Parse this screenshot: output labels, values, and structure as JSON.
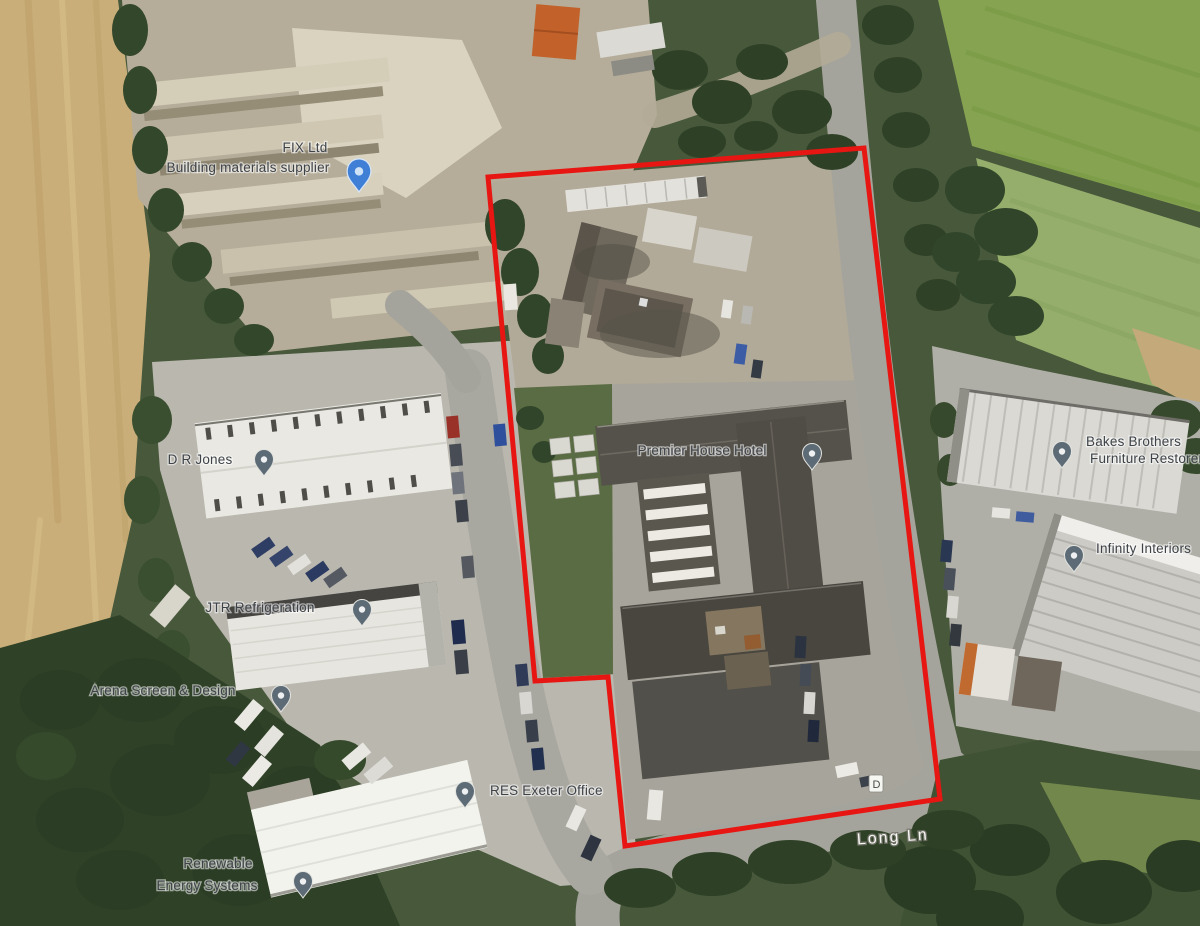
{
  "map": {
    "view": "satellite",
    "road_label": "Long Ln",
    "parcel_marker": "D",
    "boundary_color": "#e81613",
    "pin_color_gray": "#5c6b75",
    "pin_color_blue": "#3f7fd6",
    "pois": {
      "fix": {
        "name": "FIX Ltd",
        "subtitle": "Building materials supplier"
      },
      "dr_jones": {
        "name": "D R Jones"
      },
      "jtr": {
        "name": "JTR Refrigeration"
      },
      "arena": {
        "name": "Arena Screen & Design"
      },
      "premier": {
        "name": "Premier House Hotel"
      },
      "res": {
        "name": "RES Exeter Office"
      },
      "renewable": {
        "line1": "Renewable",
        "line2": "Energy Systems"
      },
      "furniture": {
        "line1": "Bakes Brothers",
        "line2": "Furniture Restorers"
      },
      "interiors": {
        "name": "Infinity Interiors"
      }
    }
  }
}
